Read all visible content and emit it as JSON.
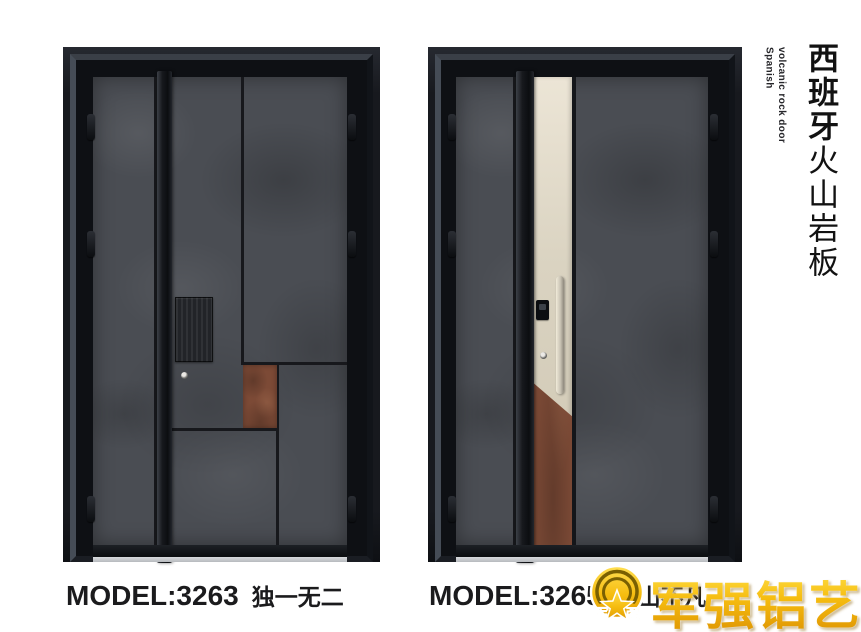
{
  "poster": {
    "background": "#ffffff"
  },
  "title_block": {
    "zh_bold": "西班牙",
    "zh_regular": "火山岩板",
    "en_line1": "Spanish",
    "en_line2": "volcanic rock door"
  },
  "products": [
    {
      "model_label": "MODEL:3263",
      "name": "独一无二"
    },
    {
      "model_label": "MODEL:3265",
      "name": "层山不凡"
    }
  ],
  "brand": {
    "logo_text": "军强铝艺",
    "badge_char_left": "军",
    "badge_char_right": "强"
  },
  "colors": {
    "frame_black": "#17191e",
    "rock_gray": "#4a4d53",
    "rust_accent": "#7c4a36",
    "champagne": "#d9d2c0",
    "brand_gold": "#f3b90d",
    "sill_gray": "#c9cbce"
  }
}
